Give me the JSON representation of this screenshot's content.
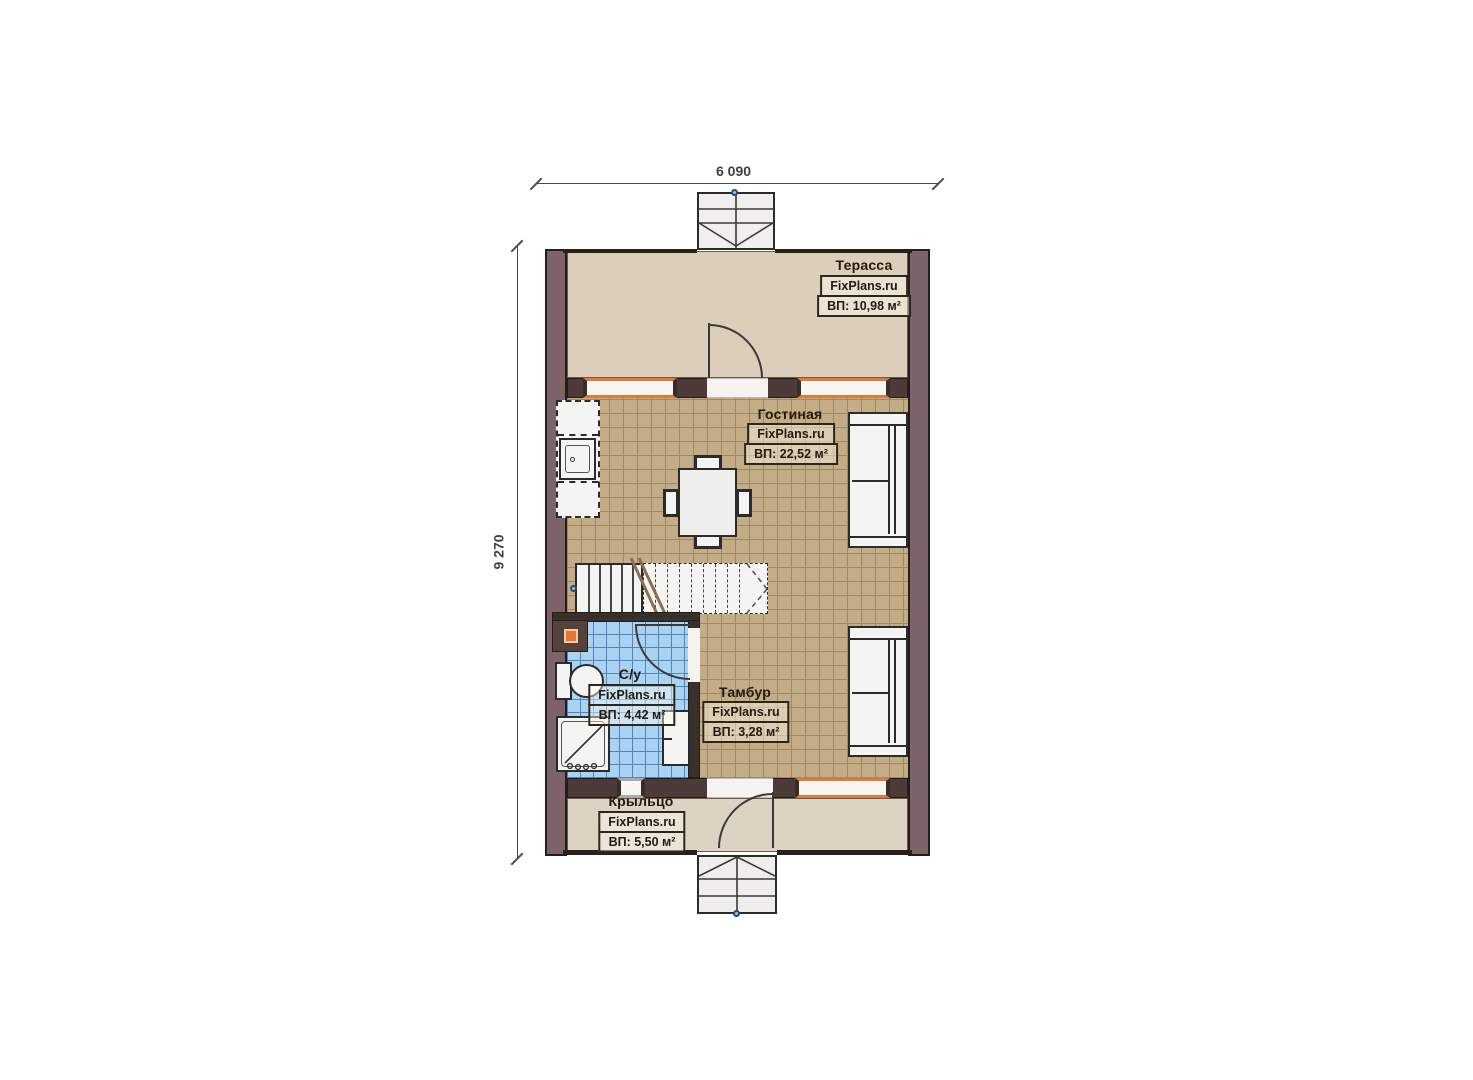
{
  "plan": {
    "title": "floor-plan",
    "dims": {
      "width_label": "6 090",
      "height_label": "9 270"
    },
    "rooms": [
      {
        "id": "terrace",
        "name": "Терасса",
        "site": "FixPlans.ru",
        "area": "ВП: 10,98 м²"
      },
      {
        "id": "living",
        "name": "Гостиная",
        "site": "FixPlans.ru",
        "area": "ВП: 22,52 м²"
      },
      {
        "id": "bathroom",
        "name": "С/у",
        "site": "FixPlans.ru",
        "area": "ВП: 4,42 м²"
      },
      {
        "id": "vestibule",
        "name": "Тамбур",
        "site": "FixPlans.ru",
        "area": "ВП: 3,28 м²"
      },
      {
        "id": "porch",
        "name": "Крыльцо",
        "site": "FixPlans.ru",
        "area": "ВП: 5,50 м²"
      }
    ],
    "colors": {
      "wall": "#7c6469",
      "wall_dark": "#4c3b38",
      "terrace_floor": "#dbcfbc",
      "tile_tan": "#c3ac86",
      "tile_blue": "#aad2f2",
      "window_frame": "#e0793a",
      "label_text": "#241a0e",
      "marker_blue": "#3b6ca6"
    }
  }
}
